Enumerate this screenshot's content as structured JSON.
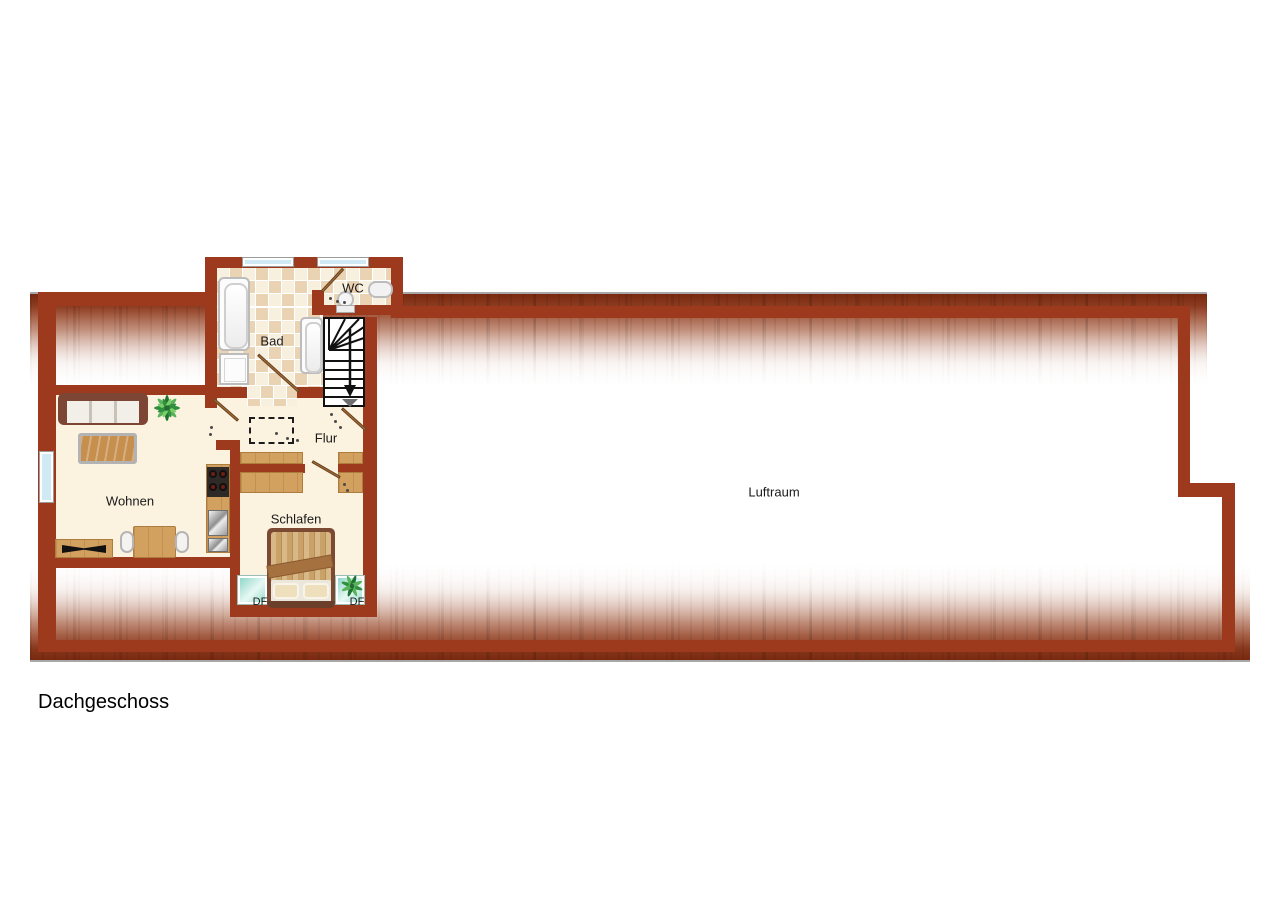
{
  "title": "Dachgeschoss",
  "rooms": {
    "living": "Wohnen",
    "bedroom": "Schlafen",
    "hall": "Flur",
    "bath": "Bad",
    "wc": "WC",
    "void": "Luftraum"
  },
  "skylights": {
    "left": "DF",
    "right": "DF"
  },
  "icons": [
    "sofa",
    "coffee-table",
    "tv-sideboard",
    "dining-table",
    "kitchen-counter",
    "stove",
    "kitchen-sink",
    "bathtub",
    "bath-cabinet",
    "shower-tub",
    "wc-toilet",
    "wc-sink",
    "stairs-down-arrow",
    "wardrobe",
    "double-bed",
    "plant",
    "roof-window",
    "door-swing"
  ],
  "colors": {
    "wall": "#9D3A1E",
    "roof_dark": "#79290F",
    "floor_cream": "#FBF2DF",
    "tile_dark": "#EAD3B2",
    "tile_light": "#F8F0DF",
    "window_blue": "#CFEAF4",
    "skylight_teal": "#8FD6C9",
    "wood": "#D2A05F",
    "plant_green": "#2F8F3F",
    "stair_marking": "#111111"
  }
}
